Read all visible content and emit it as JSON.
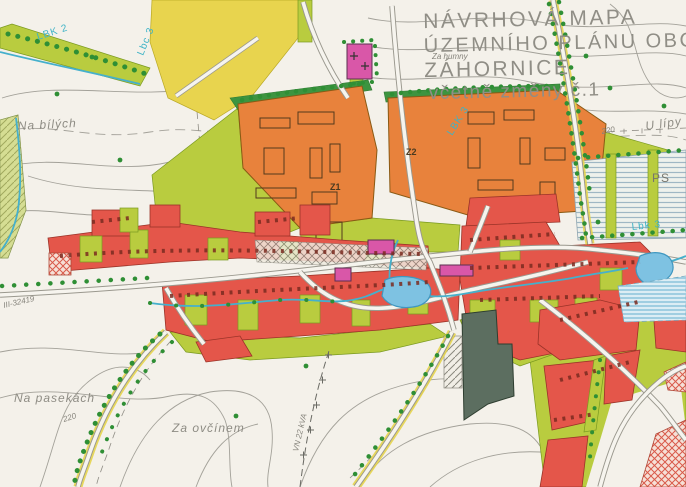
{
  "title": {
    "line1": "NÁVRHOVÁ MAPA",
    "line2": "ÚZEMNÍHO PLÁNU OBCE",
    "line3": "ZÁHORNICE",
    "line4": "včetně změny č.1"
  },
  "place_labels": {
    "za_humny": "Za humny",
    "na_bilych": "Na bílých",
    "u_lipy": "U lípy",
    "na_pasekach": "Na pasekách",
    "za_ovcinem": "Za ovčínem",
    "ps": "PS"
  },
  "map_codes": {
    "lbk2": "LBK 2",
    "lbc3": "Lbc 3",
    "lbk3_center": "LBK 3",
    "lbk3_east": "Lbk 3",
    "z1": "Z1",
    "z2": "Z2"
  },
  "annotations": {
    "road_number": "III-32419",
    "power_line": "VN 22 kVA",
    "contour_ne": "220",
    "contour_sw": "220"
  },
  "colors": {
    "paper": "#f4f1ea",
    "housing_red": "#e4564a",
    "garden_lime": "#b9cc3f",
    "field_yellow": "#e8d44e",
    "production_orange": "#e8823c",
    "greenery_green": "#3d9440",
    "water_blue": "#7ec2e2",
    "civic_magenta": "#d957a8",
    "road_grey": "#9a988e",
    "code_cyan": "#3fb3c6",
    "text_grey": "#908e86"
  }
}
